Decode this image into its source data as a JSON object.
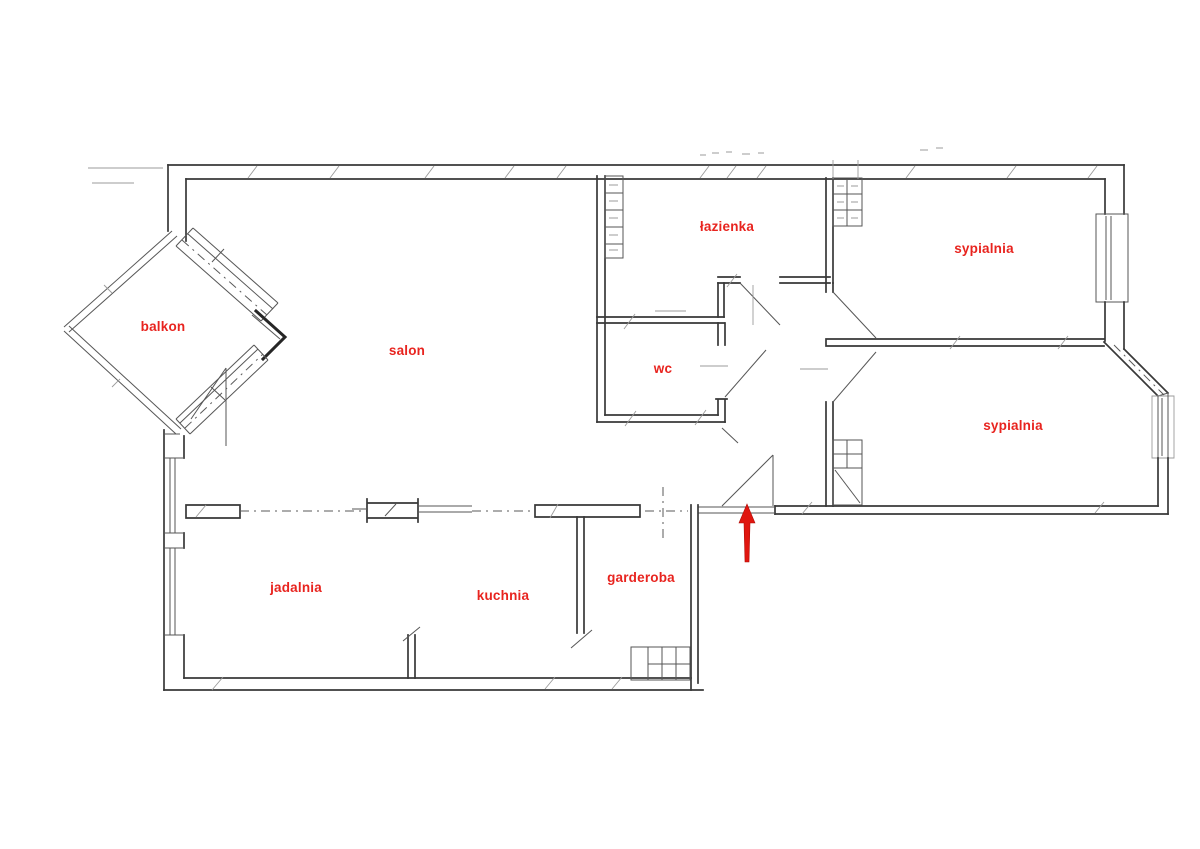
{
  "plan": {
    "type": "apartment-floor-plan",
    "label_color": "#e8241f",
    "arrow_color": "#e0160f",
    "line_color": "#383838",
    "rooms": [
      {
        "id": "balkon",
        "label": "balkon"
      },
      {
        "id": "salon",
        "label": "salon"
      },
      {
        "id": "lazienka",
        "label": "łazienka"
      },
      {
        "id": "sypialnia-1",
        "label": "sypialnia"
      },
      {
        "id": "wc",
        "label": "wc"
      },
      {
        "id": "sypialnia-2",
        "label": "sypialnia"
      },
      {
        "id": "jadalnia",
        "label": "jadalnia"
      },
      {
        "id": "kuchnia",
        "label": "kuchnia"
      },
      {
        "id": "garderoba",
        "label": "garderoba"
      }
    ],
    "entrance": {
      "marker": "red-arrow",
      "direction": "up"
    }
  }
}
